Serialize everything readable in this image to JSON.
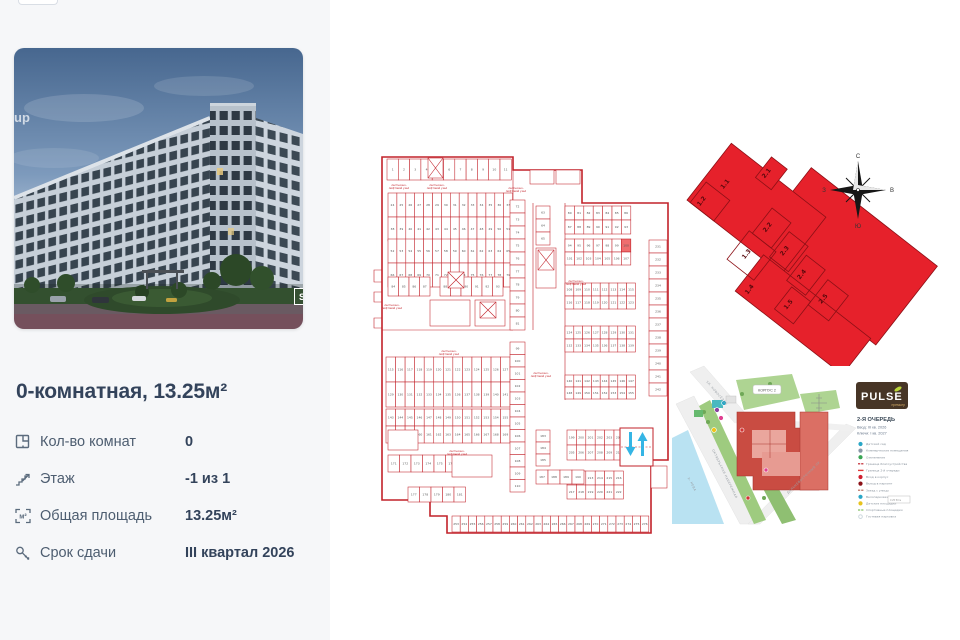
{
  "photo": {
    "watermark": "up",
    "badge": "S"
  },
  "listing": {
    "title": "0-комнатная, 13.25м²",
    "specs": [
      {
        "icon": "rooms-icon",
        "label": "Кол-во комнат",
        "value": "0"
      },
      {
        "icon": "floor-icon",
        "label": "Этаж",
        "value": "-1 из 1"
      },
      {
        "icon": "area-icon",
        "label": "Общая площадь",
        "value": "13.25м²"
      },
      {
        "icon": "key-icon",
        "label": "Срок сдачи",
        "value": "III квартал 2026"
      }
    ]
  },
  "compass": {
    "n": "С",
    "e": "В",
    "s": "Ю",
    "w": "З"
  },
  "floorplan": {
    "annotation_l1": "лестнично-",
    "annotation_l2": "лифтовой узел",
    "banks": [
      {
        "x": 387,
        "y": 159,
        "cw": 11.3,
        "ch": 21,
        "rows": 1,
        "n": 11,
        "s": 1
      },
      {
        "x": 388,
        "y": 193,
        "cw": 8.9,
        "ch": 24,
        "rows": 2,
        "n": 14,
        "s": 24
      },
      {
        "x": 388,
        "y": 239,
        "cw": 8.9,
        "ch": 24,
        "rows": 2,
        "n": 14,
        "s": 52
      },
      {
        "x": 565,
        "y": 206,
        "cw": 9.4,
        "ch": 14,
        "rows": 2,
        "n": 7,
        "s": 80
      },
      {
        "x": 565,
        "y": 239,
        "cw": 9.4,
        "ch": 13,
        "rows": 2,
        "n": 7,
        "s": 94,
        "hl": 6
      },
      {
        "x": 565,
        "y": 283,
        "cw": 8.8,
        "ch": 13,
        "rows": 2,
        "n": 8,
        "s": 108
      },
      {
        "x": 565,
        "y": 326,
        "cw": 8.8,
        "ch": 13,
        "rows": 2,
        "n": 8,
        "s": 124
      },
      {
        "x": 565,
        "y": 375,
        "cw": 8.8,
        "ch": 12,
        "rows": 2,
        "n": 8,
        "s": 140
      },
      {
        "x": 567,
        "y": 430,
        "cw": 9.4,
        "ch": 15,
        "rows": 2,
        "n": 6,
        "s": 199
      },
      {
        "x": 567,
        "y": 471,
        "cw": 9.4,
        "ch": 14,
        "rows": 2,
        "n": 6,
        "s": 211
      },
      {
        "x": 386,
        "y": 357,
        "cw": 9.55,
        "ch": 25,
        "rows": 2,
        "n": 14,
        "s": 115
      },
      {
        "x": 386,
        "y": 409,
        "cw": 9.55,
        "ch": 17,
        "rows": 2,
        "n": 14,
        "s": 143
      },
      {
        "x": 452,
        "y": 516,
        "cw": 8.2,
        "ch": 16,
        "rows": 1,
        "n": 24,
        "s": 253
      },
      {
        "x": 649,
        "y": 240,
        "cw": 18,
        "ch": 13,
        "n": 12,
        "s": 231,
        "vert": 1
      },
      {
        "x": 510,
        "y": 200,
        "cw": 15,
        "ch": 13,
        "n": 10,
        "s": 72,
        "vert": 1
      },
      {
        "x": 510,
        "y": 342,
        "cw": 15,
        "ch": 12.5,
        "n": 12,
        "s": 99,
        "vert": 1
      },
      {
        "x": 536,
        "y": 206,
        "cw": 14,
        "ch": 13,
        "n": 3,
        "s": 63,
        "vert": 1
      },
      {
        "x": 536,
        "y": 430,
        "cw": 14,
        "ch": 12,
        "n": 3,
        "s": 183,
        "vert": 1
      },
      {
        "x": 388,
        "y": 277,
        "cw": 10.5,
        "ch": 19,
        "rows": 1,
        "n": 4,
        "s": 84
      },
      {
        "x": 440,
        "y": 277,
        "cw": 10.5,
        "ch": 19,
        "rows": 1,
        "n": 6,
        "s": 88
      },
      {
        "x": 388,
        "y": 455,
        "cw": 11.5,
        "ch": 17,
        "rows": 1,
        "n": 6,
        "s": 171
      },
      {
        "x": 408,
        "y": 487,
        "cw": 11.5,
        "ch": 15,
        "rows": 1,
        "n": 5,
        "s": 177
      },
      {
        "x": 536,
        "y": 470,
        "cw": 12,
        "ch": 14,
        "rows": 1,
        "n": 4,
        "s": 187
      }
    ],
    "rooms": [
      [
        530,
        170,
        24,
        14
      ],
      [
        556,
        170,
        24,
        14
      ],
      [
        536,
        248,
        20,
        40
      ],
      [
        430,
        300,
        40,
        26
      ],
      [
        475,
        300,
        30,
        26
      ],
      [
        452,
        455,
        40,
        22
      ],
      [
        388,
        430,
        30,
        20
      ],
      [
        651,
        466,
        16,
        22
      ]
    ],
    "stairs": [
      [
        428,
        158,
        15,
        20
      ],
      [
        448,
        272,
        16,
        16
      ],
      [
        480,
        302,
        16,
        16
      ],
      [
        538,
        250,
        16,
        20
      ]
    ],
    "annotations": [
      [
        399,
        186
      ],
      [
        437,
        186
      ],
      [
        516,
        189
      ],
      [
        392,
        306
      ],
      [
        449,
        352
      ],
      [
        541,
        374
      ],
      [
        576,
        282
      ],
      [
        457,
        452
      ]
    ],
    "highlight": {
      "x": 621.4,
      "y": 239,
      "w": 9.4,
      "h": 13
    }
  },
  "footprint": {
    "labels": [
      {
        "t": "1.1",
        "x": -88,
        "y": -16
      },
      {
        "t": "1.2",
        "x": -96,
        "y": 12
      },
      {
        "t": "1.3",
        "x": -28,
        "y": 26
      },
      {
        "t": "1.4",
        "x": -4,
        "y": 52
      },
      {
        "t": "1.5",
        "x": 36,
        "y": 40
      },
      {
        "t": "2.1",
        "x": -62,
        "y": -50
      },
      {
        "t": "2.2",
        "x": -28,
        "y": -8
      },
      {
        "t": "2.3",
        "x": 0,
        "y": 0
      },
      {
        "t": "2.4",
        "x": 28,
        "y": 8
      },
      {
        "t": "2.5",
        "x": 60,
        "y": 14
      }
    ]
  },
  "sitemap": {
    "korpus_label": "КОРПУС 2",
    "river_label": "р. НЕВА",
    "streets": [
      "ОКТЯБРЬСКАЯ НАБЕРЕЖНАЯ",
      "УЛ. НОВОСЁЛОВ",
      "ДАЛЬНЕВОСТОЧНЫЙ ПР."
    ],
    "brand": {
      "name": "PULSE",
      "sub": "премьер"
    },
    "phase": {
      "title": "2-Я ОЧЕРЕДЬ",
      "line1": "Ввод: III кв. 2026",
      "line2": "Ключи: I кв. 2027"
    },
    "legend_y": 444,
    "legend": [
      {
        "type": "circle",
        "color": "#2aa7c7",
        "label": "Детский сад"
      },
      {
        "type": "circle",
        "color": "#8a98a8",
        "label": "Коммерческие помещения"
      },
      {
        "type": "circle",
        "color": "#3aa655",
        "label": "Озеленение"
      },
      {
        "type": "dash",
        "color": "#c0242c",
        "label": "Граница благоустройства"
      },
      {
        "type": "line",
        "color": "#e03a3a",
        "label": "Граница 2-й очереди"
      },
      {
        "type": "circle",
        "color": "#d01f2f",
        "label": "Вход в корпус"
      },
      {
        "type": "circle",
        "color": "#8c1218",
        "label": "Въезд в паркинг"
      },
      {
        "type": "dash",
        "color": "#b86a5a",
        "label": "Заезд с улицы"
      },
      {
        "type": "circle",
        "color": "#2aa7c7",
        "label": "Велопарковки"
      },
      {
        "type": "circle",
        "color": "#e8c31e",
        "label": "Детские площадки"
      },
      {
        "type": "dash",
        "color": "#7fbf5f",
        "label": "Спортивные площадки"
      },
      {
        "type": "dot",
        "color": "#c8d4da",
        "label": "Гостевая парковка"
      }
    ],
    "scale": "0   25   50 м"
  }
}
